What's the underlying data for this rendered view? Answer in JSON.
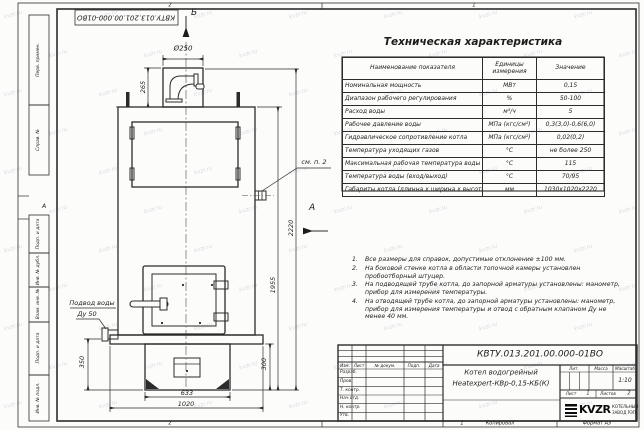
{
  "watermark": {
    "text": "kvzr.ru"
  },
  "sheet": {
    "doc_number_top": "КВТУ.013.201.00.000-01ВО",
    "zones": {
      "top_left": "2",
      "top_right": "1",
      "bottom_left": "2",
      "bottom_right": "1",
      "side_letter": "А"
    },
    "side_fields": [
      "Перв. примен.",
      "Справ. №",
      "Подп. и дата",
      "Инв. № дубл.",
      "Взам. инв. №",
      "Подп. и дата",
      "Инв. № подл."
    ],
    "footer": {
      "copied": "Копировал",
      "format": "Формат А3"
    }
  },
  "spec_table": {
    "title": "Техническая характеристика",
    "headers": [
      "Наименование показателя",
      "Единицы измерения",
      "Значение"
    ],
    "rows": [
      {
        "name": "Номинальная мощность",
        "unit": "МВт",
        "value": "0,15"
      },
      {
        "name": "Диапазон рабочего регулирования",
        "unit": "%",
        "value": "50-100"
      },
      {
        "name": "Расход воды",
        "unit": "м³/ч",
        "value": "5"
      },
      {
        "name": "Рабочее давление воды",
        "unit": "МПа (кгс/см²)",
        "value": "0,3(3,0)-0,6(6,0)"
      },
      {
        "name": "Гидравлическое сопротивление котла",
        "unit": "МПа (кгс/см²)",
        "value": "0,02(0,2)"
      },
      {
        "name": "Температура уходящих газов",
        "unit": "°С",
        "value": "не более 250"
      },
      {
        "name": "Максимальная рабочая температура воды",
        "unit": "°С",
        "value": "115"
      },
      {
        "name": "Температура воды (вход/выход)",
        "unit": "°С",
        "value": "70/95"
      },
      {
        "name": "Габариты котла (длинна х ширина х высота)",
        "unit": "мм",
        "value": "1030х1020х2220"
      }
    ]
  },
  "notes": {
    "items": [
      {
        "num": "1.",
        "text": "Все размеры для справок, допустимые отклонение ±100 мм."
      },
      {
        "num": "2.",
        "text": "На боковой стенке котла в области топочной камеры установлен пробоотборный штуцер."
      },
      {
        "num": "3.",
        "text": "На подводящей трубе котла, до запорной арматуры установлены: манометр, прибор для измерения температуры."
      },
      {
        "num": "4.",
        "text": "На отводящей трубе котла, до запорной арматуры установлены: манометр, прибор для измерения температуры и отвод с обратным клапаном Ду не менее 40 мм."
      }
    ]
  },
  "drawing": {
    "view_labels": {
      "b": "Б",
      "a": "А"
    },
    "callouts": {
      "see_note": "см. п. 2",
      "water_line1": "Подвод воды",
      "water_line2": "Ду 50"
    },
    "dimensions": {
      "chimney_diameter": "Ø250",
      "chimney_height": "265",
      "total_height": "2220",
      "body_height": "1955",
      "pedestal_height": "300",
      "stub_height": "350",
      "pedestal_width": "633",
      "base_width": "1020"
    }
  },
  "title_block": {
    "doc_number": "КВТУ.013.201.00.000-01ВО",
    "product_name_1": "Котел водогрейный",
    "product_name_2": "Heatexpert-КВр-0,15-КБ(К)",
    "header_cols": [
      "Изм.",
      "Лист",
      "№ докум.",
      "Подп.",
      "Дата"
    ],
    "sign_rows": [
      "Разраб.",
      "Пров.",
      "Т. контр.",
      "Нач.отд.",
      "Н. контр.",
      "Утв."
    ],
    "lit_label": "Лит.",
    "mass_label": "Масса",
    "scale_label": "Масштаб",
    "scale_value": "1:10",
    "sheet_label": "Лист",
    "sheet_value": "1",
    "sheets_label": "Листов",
    "sheets_value": "2",
    "logo_text": "KVZR",
    "logo_sub_1": "КОТЕЛЬНЫЙ",
    "logo_sub_2": "ЗАВОД РЭП"
  }
}
